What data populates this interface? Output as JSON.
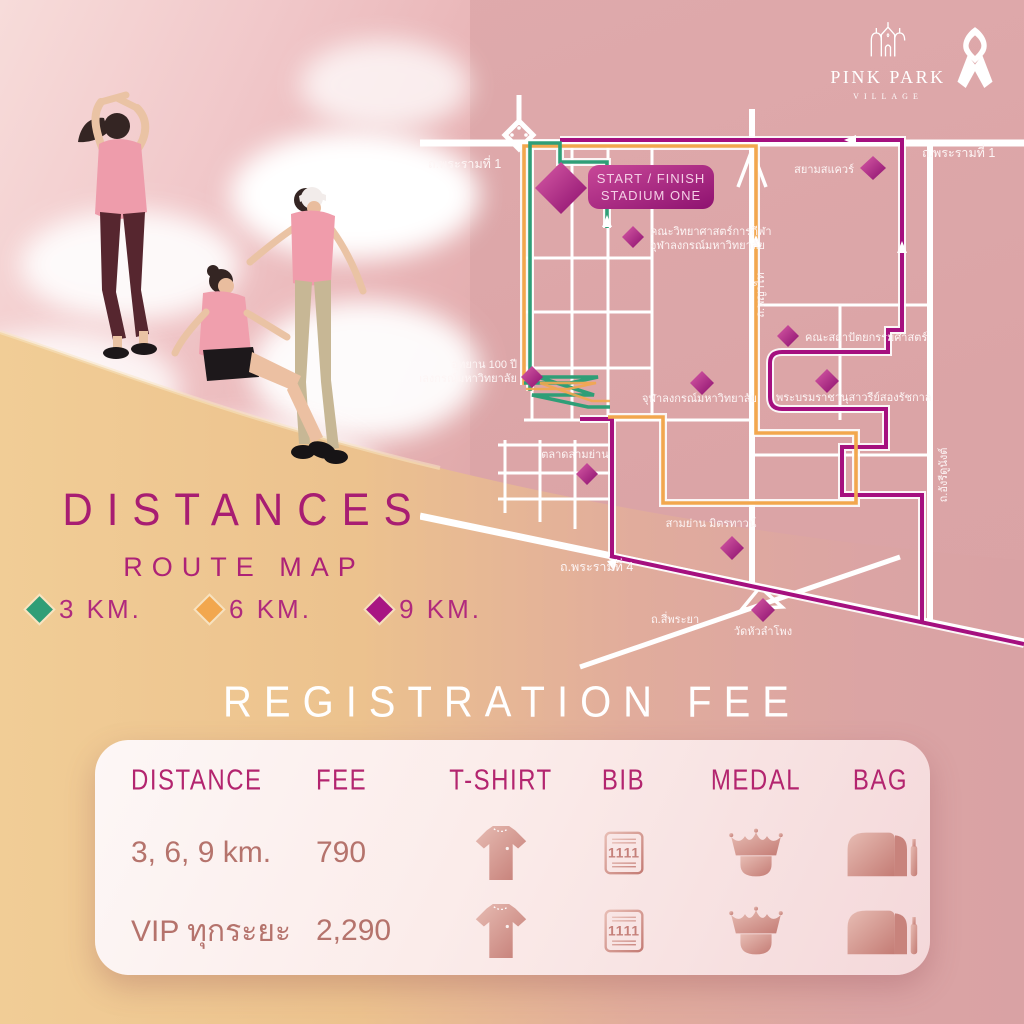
{
  "brand": {
    "logo_title": "PINK PARK",
    "logo_subtitle": "VILLAGE",
    "logo_icon": "castle-icon",
    "ribbon_icon": "pink-ribbon-awareness"
  },
  "colors": {
    "background_pink": "#dba4a6",
    "background_sand": "#eeca93",
    "accent_magenta": "#a81d72",
    "route_3km": "#2f9e77",
    "route_6km": "#f2a74e",
    "route_9km": "#a5107f",
    "marker_diamond": "#a81583",
    "table_text": "#b5736c",
    "icon_rosegold": "#cf8d86"
  },
  "map": {
    "start_line1": "START / FINISH",
    "start_line2": "STADIUM ONE",
    "rama1_left": "ถ.พระรามที่ 1",
    "rama1_right": "ถ.พระรามที่ 1",
    "phayathai": "ถ.พญาไท",
    "henri_dunant": "ถ.อังรีดูนังต์",
    "rama4": "ถ.พระรามที่ 4",
    "si_phraya": "ถ.สี่พระยา",
    "siam_square": "สยามสแควร์",
    "sport_science_1": "คณะวิทยาศาสตร์การกีฬา",
    "sport_science_2": "จุฬาลงกรณ์มหาวิทยาลัย",
    "park100_1": "อุทยาน 100 ปี",
    "park100_2": "จุฬาลงกรณ์มหาวิทยาลัย",
    "chula": "จุฬาลงกรณ์มหาวิทยาลัย",
    "architecture": "คณะสถาปัตยกรรมศาสตร์",
    "monument": "พระบรมราชานุสาวรีย์สองรัชกาล",
    "talat_samyan": "ตลาดสามย่าน",
    "samyan_mitrtown": "สามย่าน มิตรทาวน์",
    "wat_hua_lamphong": "วัดหัวลำโพง"
  },
  "distances": {
    "title": "DISTANCES",
    "subtitle": "ROUTE MAP",
    "legend": [
      {
        "label": "3 KM.",
        "color": "#2f9e77"
      },
      {
        "label": "6 KM.",
        "color": "#f2a74e"
      },
      {
        "label": "9 KM.",
        "color": "#a81583"
      }
    ]
  },
  "registration": {
    "title": "REGISTRATION FEE",
    "columns": [
      "DISTANCE",
      "FEE",
      "T-SHIRT",
      "BIB",
      "MEDAL",
      "BAG"
    ],
    "bib_number": "1111",
    "rows": [
      {
        "distance": "3, 6, 9 km.",
        "fee": "790"
      },
      {
        "distance": "VIP ทุกระยะ",
        "fee": "2,290"
      }
    ]
  }
}
